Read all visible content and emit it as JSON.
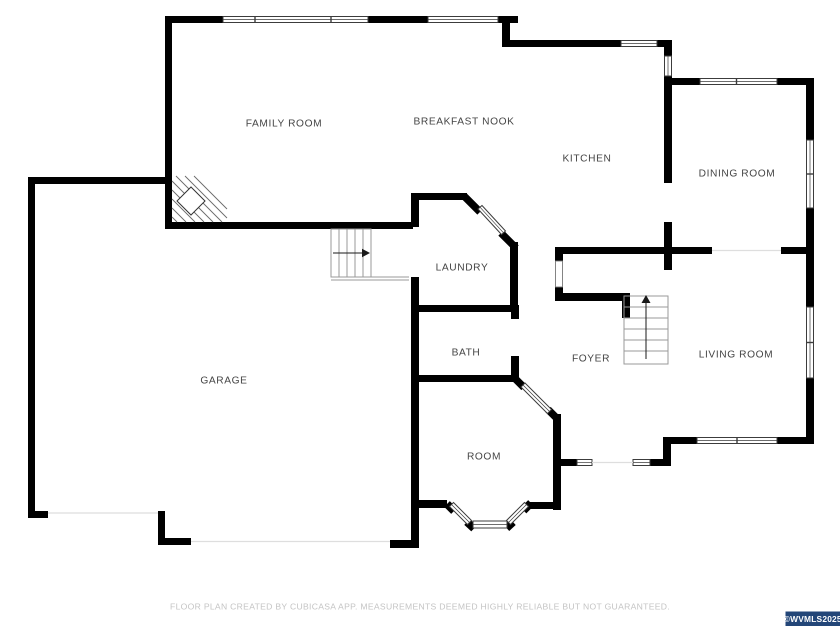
{
  "rooms": {
    "family_room": {
      "label": "FAMILY ROOM"
    },
    "breakfast_nook": {
      "label": "BREAKFAST NOOK"
    },
    "kitchen": {
      "label": "KITCHEN"
    },
    "dining_room": {
      "label": "DINING ROOM"
    },
    "laundry": {
      "label": "LAUNDRY"
    },
    "bath": {
      "label": "BATH"
    },
    "foyer": {
      "label": "FOYER"
    },
    "living_room": {
      "label": "LIVING ROOM"
    },
    "garage": {
      "label": "GARAGE"
    },
    "room": {
      "label": "ROOM"
    }
  },
  "footer": {
    "disclaimer": "FLOOR PLAN CREATED BY CUBICASA APP. MEASUREMENTS DEEMED HIGHLY RELIABLE BUT NOT GUARANTEED."
  },
  "watermark": {
    "text": "©WVMLS2025",
    "background": "#234678",
    "text_color": "#ffffff"
  },
  "colors": {
    "wall": "#000000",
    "label_text": "#454545",
    "footer_text": "#c4c4c4"
  }
}
